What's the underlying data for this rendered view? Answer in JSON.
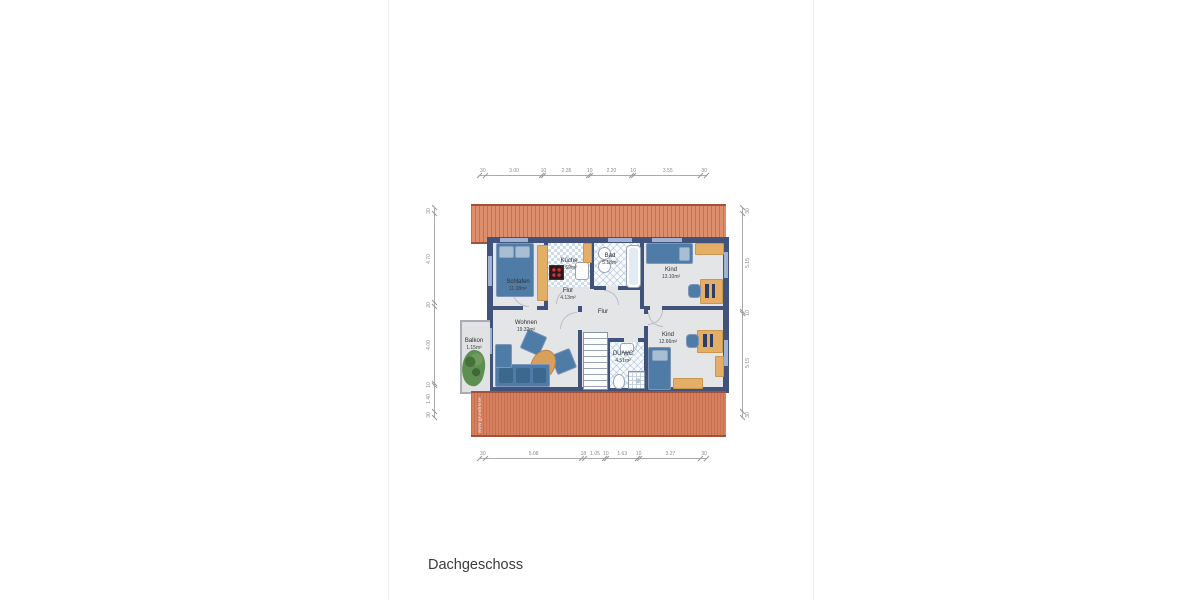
{
  "page": {
    "title": "Dachgeschoss",
    "watermark": "www.grundrisse"
  },
  "rooms": {
    "schlafen": {
      "name": "Schlafen",
      "area": "11.08m²"
    },
    "kueche": {
      "name": "Küche",
      "area": "5.69m²"
    },
    "bad": {
      "name": "Bad",
      "area": "5.18m²"
    },
    "kind1": {
      "name": "Kind",
      "area": "13.10m²"
    },
    "flur1": {
      "name": "Flur",
      "area": "4.13m²"
    },
    "flur2": {
      "name": "Flur",
      "area": ""
    },
    "wohnen": {
      "name": "Wohnen",
      "area": "19.32m²"
    },
    "balkon": {
      "name": "Balkon",
      "area": "1.15m²"
    },
    "duwc": {
      "name": "DU/WC",
      "area": "4.51m²"
    },
    "kind2": {
      "name": "Kind",
      "area": "12.66m²"
    }
  },
  "dimensions": {
    "top": [
      "30",
      "3.00",
      "10",
      "2.35",
      "10",
      "2.20",
      "10",
      "3.55",
      "30"
    ],
    "bottom": [
      "30",
      "5.08",
      "18",
      "1.05",
      "10",
      "1.63",
      "10",
      "3.27",
      "30"
    ],
    "left": [
      "30",
      "4.70",
      "20",
      "4.00",
      "10",
      "1.40",
      "30"
    ],
    "right": [
      "30",
      "5.15",
      "10",
      "5.15",
      "30"
    ]
  },
  "colors": {
    "wall": "#41537a",
    "floor": "#e3e5e7",
    "roof_base": "#dd8e6d",
    "roof_base2": "#d5805f",
    "roof_stripe": "#c96f4e",
    "furniture_blue": "#4f7ca6",
    "furniture_wood": "#e5ae67"
  }
}
